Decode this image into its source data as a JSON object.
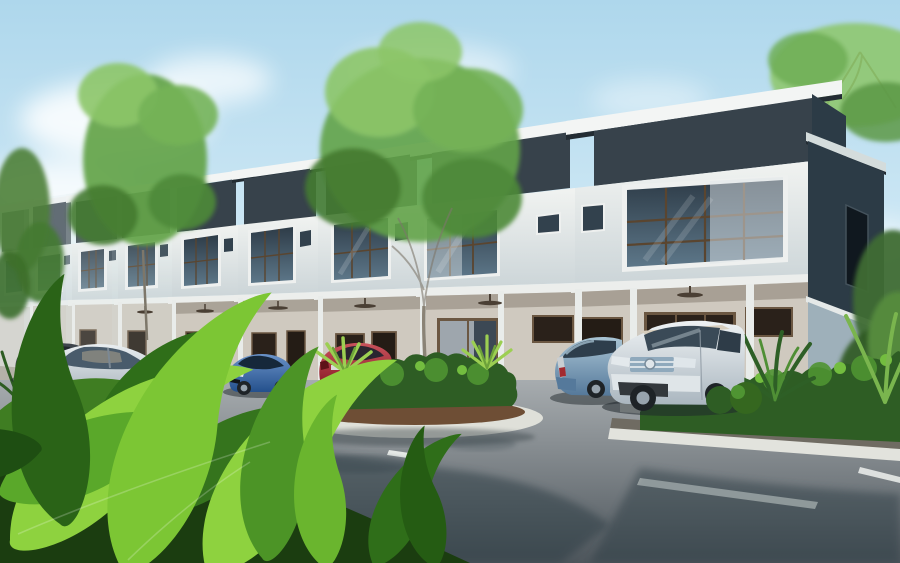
{
  "scene": {
    "label": "3d-architectural-render",
    "subject": "modern-two-storey-terrace-houses",
    "house_units_visible": 9,
    "storeys": 2,
    "sky": "clear-blue-with-soft-clouds",
    "road": {
      "surface": "asphalt",
      "marking": "dashed-white-centerline",
      "curbs": "white-concrete",
      "sidewalk": "paver-blocks"
    },
    "cars": [
      {
        "name": "dark-grey-car",
        "position": "far-left"
      },
      {
        "name": "silver-honda-coupe",
        "position": "left"
      },
      {
        "name": "blue-sedan",
        "position": "center-left"
      },
      {
        "name": "red-sedan",
        "position": "center"
      },
      {
        "name": "steel-blue-hatchback",
        "position": "center-right"
      },
      {
        "name": "silver-honda-suv",
        "position": "right"
      }
    ],
    "vegetation": [
      "far-left-tree",
      "left-tree",
      "center-tree",
      "top-right-tree",
      "right-background-trees",
      "shrub-island",
      "right-hedge",
      "palm-plants",
      "foreground-tropical-leaves"
    ]
  },
  "palette": {
    "sky_top": "#aed7ec",
    "sky_horizon": "#eef7fb",
    "cloud": "#ffffff",
    "roof_charcoal": "#37424b",
    "roof_under": "#232c33",
    "fascia": "#f3f5f4",
    "wall_top": "#f1f3f1",
    "wall_bottom": "#ccd5d8",
    "wall_shadow": "#b9c5cb",
    "glass_top": "#2e3c48",
    "glass_bottom": "#5d7789",
    "frame_brown": "#5a452f",
    "curtain": "#e0e6e9",
    "porch_wall": "#cfc9bf",
    "porch_ceiling_shadow": "#9e968b",
    "opening_dark": "#241c15",
    "side_dark": "#2c3b46",
    "side_light": "#9eb0ba",
    "apron": "#b5b2a8",
    "curb": "#e2e3dd",
    "paver": "#7d7769",
    "road_top": "#a8adb0",
    "road_bottom": "#4e565c",
    "road_shadow": "#2b3a42",
    "dash": "#eef1ee",
    "mulch": "#6e4e35",
    "island_curb": "#dfe0d9",
    "bush_dark": "#2e5d24",
    "bush_mid": "#4f9432",
    "bush_light": "#73bd3f",
    "spiky": "#9ccf52",
    "tree_light": "#8cc568",
    "tree_mid": "#63a348",
    "tree_dark": "#447a31",
    "trunk": "#8a8376",
    "leaf_bright": "#8ed23f",
    "leaf_mid": "#5aa82a",
    "leaf_dark": "#2f6e19",
    "leaf_deep": "#1b3d10",
    "car_dark": "#3e454c",
    "silver_light": "#e9eef1",
    "silver_dark": "#9fabb4",
    "blue_light": "#6a92c8",
    "blue_dark": "#24508c",
    "red_light": "#c9525c",
    "red_dark": "#8c1e29",
    "steel_light": "#a9c4d4",
    "steel_dark": "#54789a",
    "suv_light": "#eef2f4",
    "suv_dark": "#aab6bf",
    "tire": "#1e2327",
    "rim": "#97a3ad",
    "headlight": "#e3e9ec",
    "taillight": "#a32a30",
    "chrome": "#8fa9bc"
  }
}
